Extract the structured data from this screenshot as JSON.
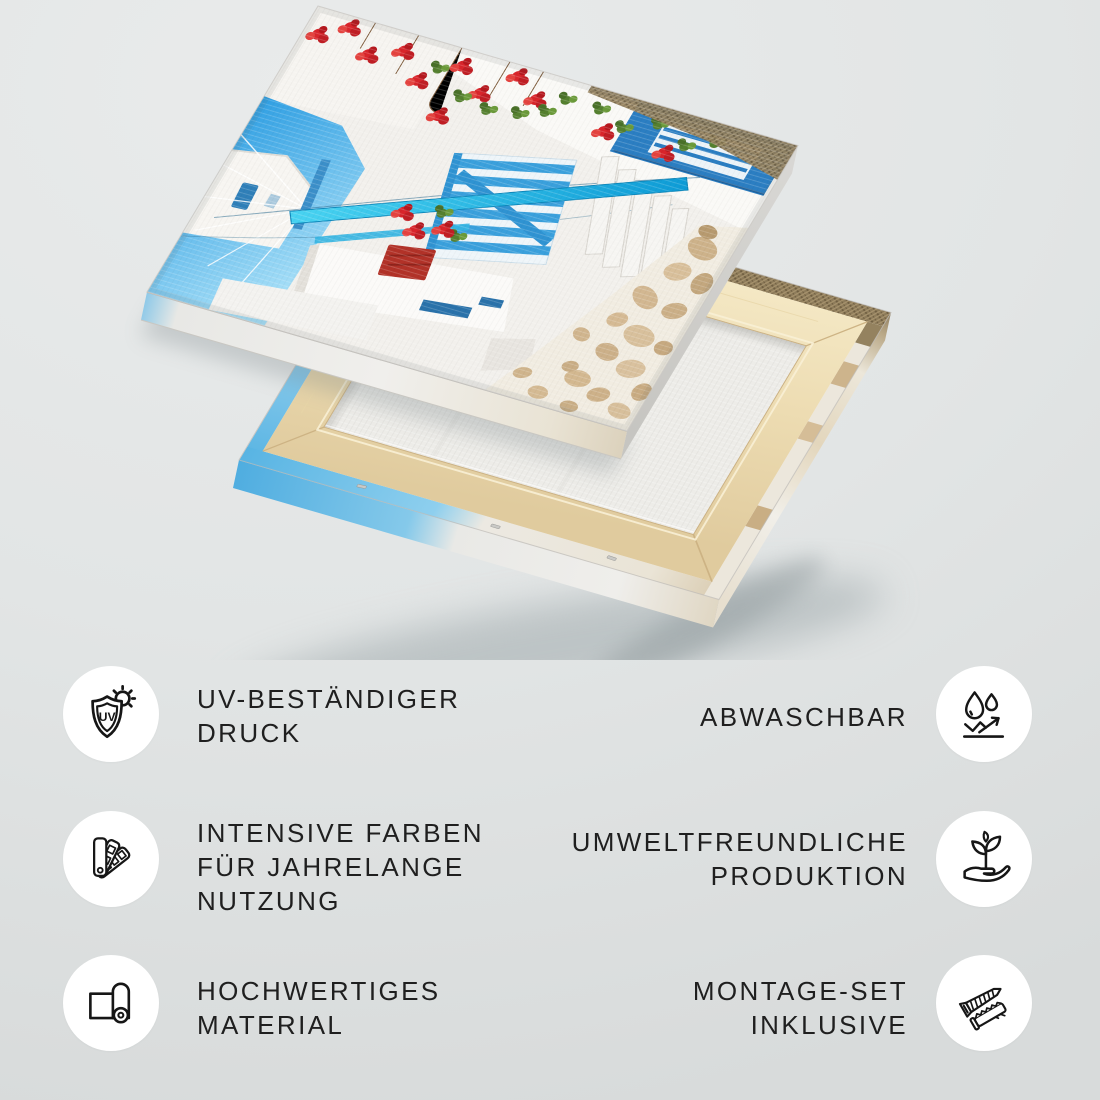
{
  "page": {
    "background_color": "#e2e5e5",
    "text_color": "#1f1f1f",
    "icon_stroke_color": "#161616",
    "icon_circle_color": "#ffffff"
  },
  "hero": {
    "front_canvas": {
      "name": "canvas-print-front",
      "scene": "greek-island-white-street",
      "palette": {
        "sky_blue": "#2f9fe3",
        "beam_cyan": "#18b4e6",
        "gate_blue": "#3aa0dc",
        "door_band_blue": "#2b7ec2",
        "flower_red": "#d8252b",
        "leaf_green": "#55802f",
        "stone_beige": "#d2b791",
        "wall_white": "#f2f0ec"
      }
    },
    "back_canvas": {
      "name": "canvas-print-back",
      "palette": {
        "wood_frame": "#eddcb2",
        "canvas_fabric": "#edece8",
        "wrap_blue": "#58b4e3",
        "wrap_beige": "#d9cbb0"
      }
    }
  },
  "features": {
    "rows": [
      {
        "left": {
          "icon": "uv-shield-icon",
          "icon_text": "UV",
          "lines": [
            "UV-BESTÄNDIGER",
            "DRUCK"
          ]
        },
        "right": {
          "icon": "washable-icon",
          "lines": [
            "ABWASCHBAR"
          ]
        }
      },
      {
        "left": {
          "icon": "color-fan-icon",
          "lines": [
            "INTENSIVE FARBEN",
            "FÜR JAHRELANGE",
            "NUTZUNG"
          ]
        },
        "right": {
          "icon": "eco-production-icon",
          "lines": [
            "UMWELTFREUNDLICHE",
            "PRODUKTION"
          ]
        }
      },
      {
        "left": {
          "icon": "material-roll-icon",
          "lines": [
            "HOCHWERTIGES",
            "MATERIAL"
          ]
        },
        "right": {
          "icon": "mounting-set-icon",
          "lines": [
            "MONTAGE-SET",
            "INKLUSIVE"
          ]
        }
      }
    ]
  }
}
